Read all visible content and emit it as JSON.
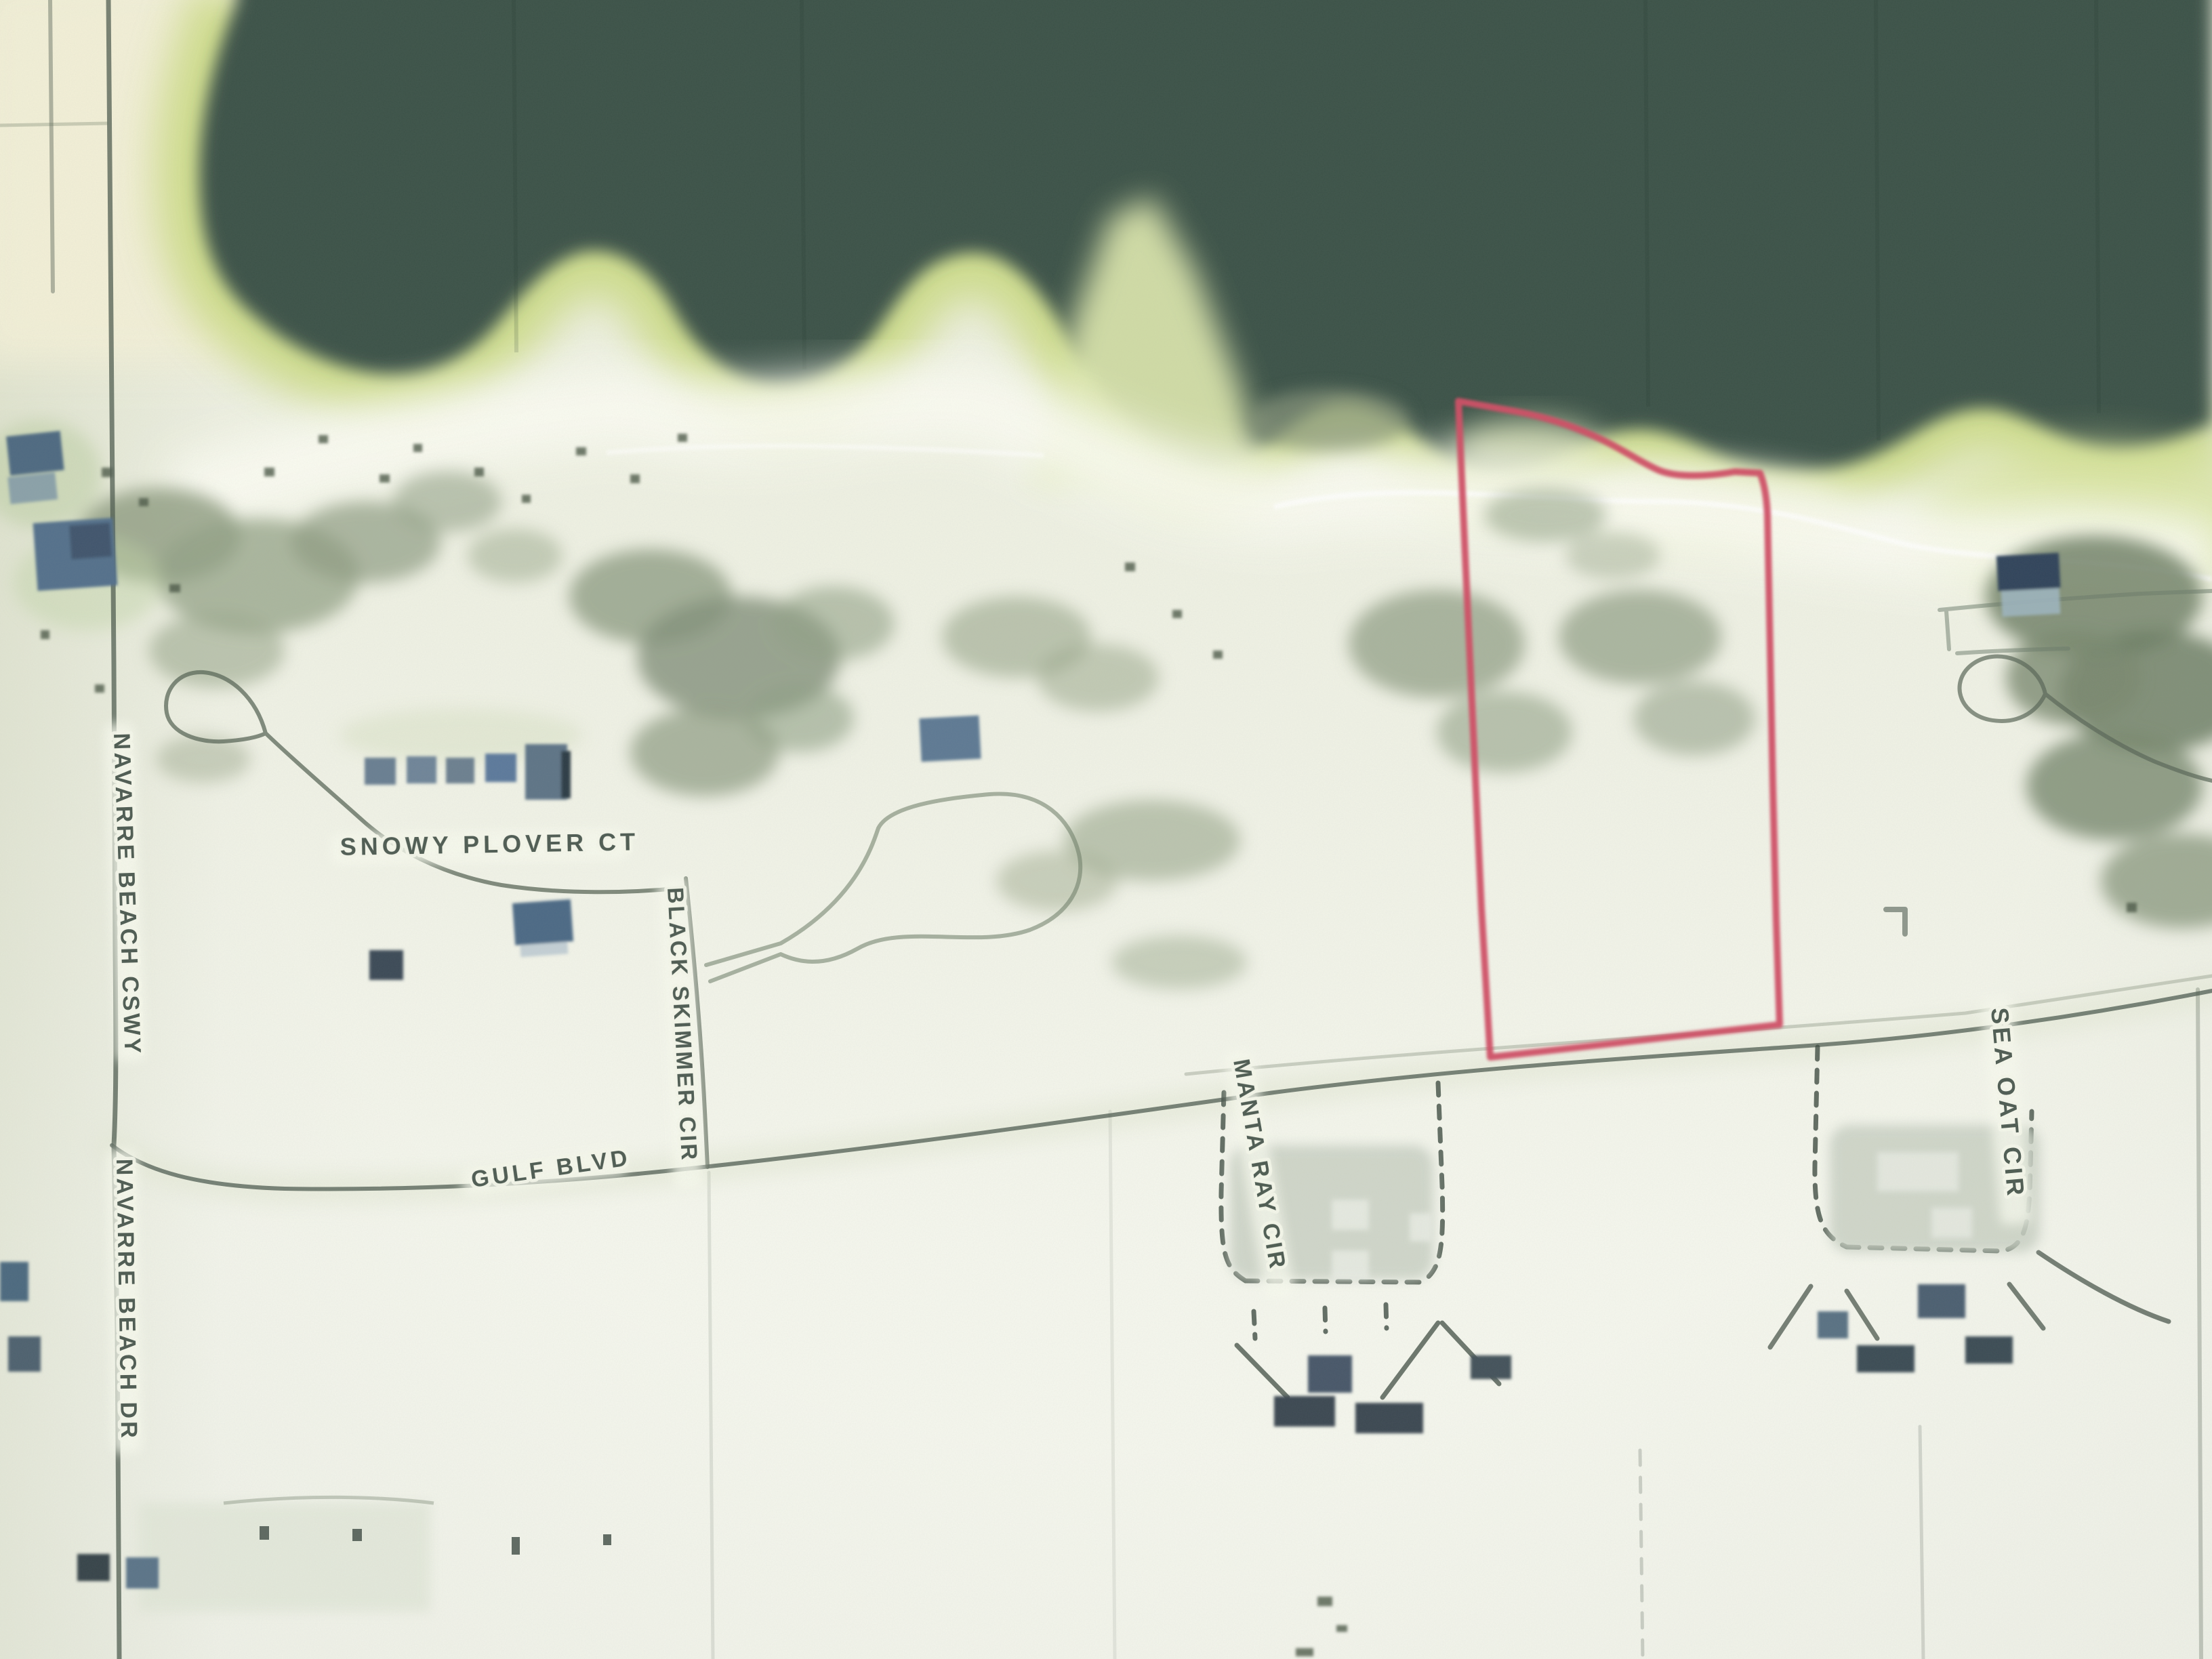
{
  "map": {
    "kind": "aerial-photo-parcel-map",
    "streets": {
      "navarre_beach_cswy": "NAVARRE BEACH CSWY",
      "navarre_beach_dr": "NAVARRE BEACH DR",
      "snowy_plover_ct": "SNOWY PLOVER CT",
      "black_skimmer_cir": "BLACK SKIMMER CIR",
      "gulf_blvd": "GULF BLVD",
      "manta_ray_cir": "MANTA RAY CIR",
      "sea_oat_cir": "SEA OAT CIR"
    },
    "parcel": {
      "outline_color": "#d05066"
    },
    "colors": {
      "water": "#3c534a",
      "shallows": "#ccdb86",
      "sand": "#eef0e3",
      "beach": "#fafbf2",
      "scrub": "#8a987d",
      "road": "#57645a",
      "label_text": "#414f46",
      "house_roof": "#54718c"
    }
  }
}
